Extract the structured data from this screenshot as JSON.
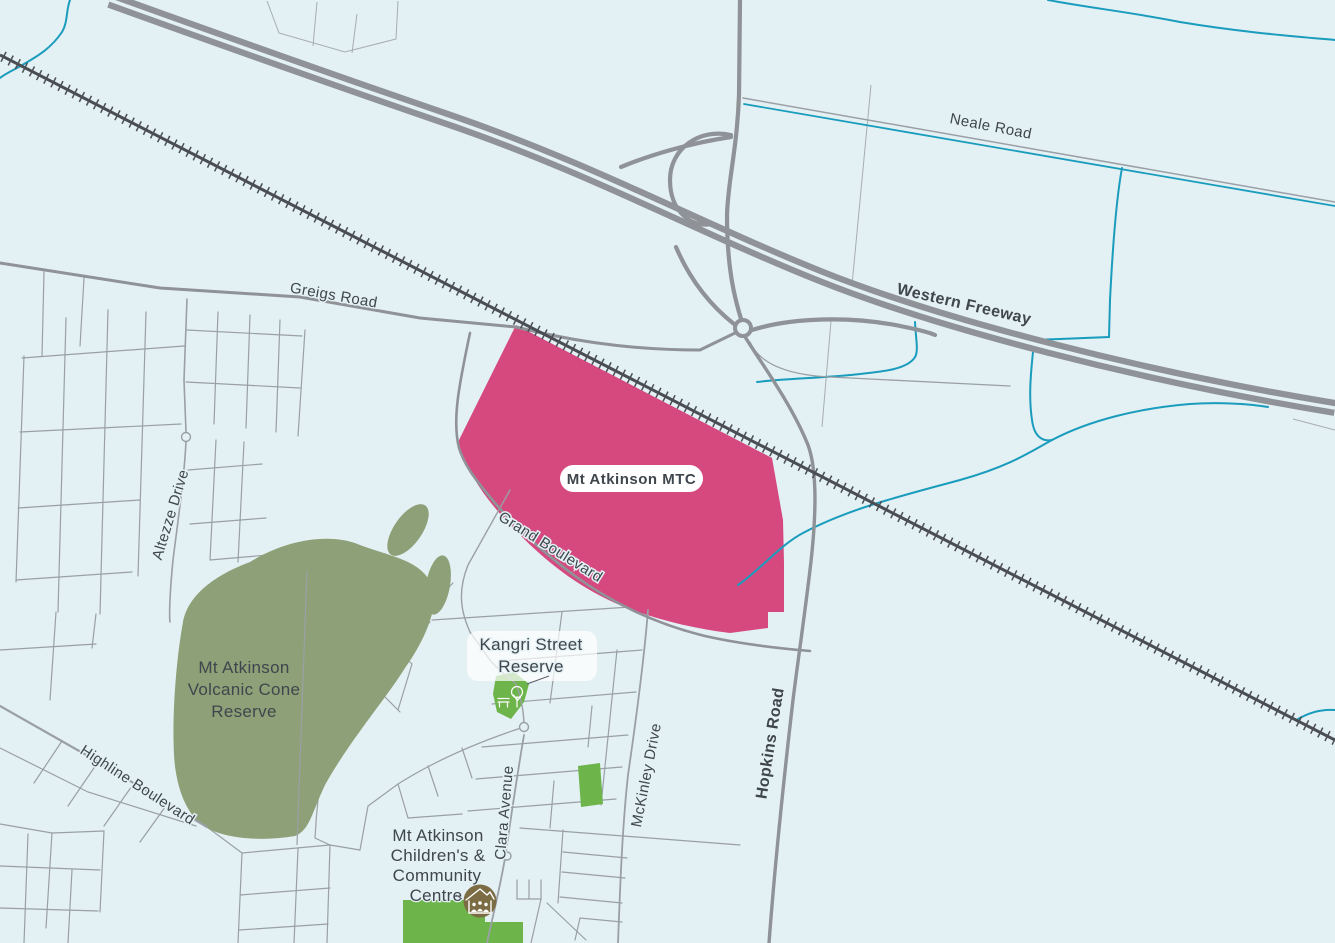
{
  "title": "Mt Atkinson MTC location map",
  "colors": {
    "background": "#e3f0f4",
    "water": "#1a9cbd",
    "railway": "#4a4e53",
    "road_major": "#8f9296",
    "road_minor": "#9aa0a5",
    "field_line": "#a7adb2",
    "reserve_green": "#8da077",
    "park_green": "#6db44a",
    "mtc_pink": "#d6497e",
    "mtc_label_pink": "#e0457f",
    "label_dark": "#3f464d",
    "icon_brown": "#7b6c44",
    "label_pill_fill": "#ffffff"
  },
  "labels": {
    "mtc": "Mt Atkinson MTC",
    "neale_road": "Neale Road",
    "western_freeway": "Western Freeway",
    "greigs_road": "Greigs Road",
    "grand_boulevard": "Grand Boulevard",
    "hopkins_road": "Hopkins Road",
    "mckinley_drive": "McKinley Drive",
    "clara_avenue": "Clara Avenue",
    "altezze_drive": "Altezze Drive",
    "highline_boulevard": "Highline Boulevard",
    "volcanic_reserve": [
      "Mt Atkinson",
      "Volcanic Cone",
      "Reserve"
    ],
    "kangri_reserve": [
      "Kangri Street",
      "Reserve"
    ],
    "community_centre": [
      "Mt Atkinson",
      "Children's &",
      "Community",
      "Centre"
    ]
  },
  "icons": [
    {
      "name": "tree-icon",
      "location": "Kangri Street Reserve"
    },
    {
      "name": "bench-icon",
      "location": "Kangri Street Reserve"
    },
    {
      "name": "community-centre-icon",
      "location": "Mt Atkinson Children's & Community Centre"
    }
  ]
}
